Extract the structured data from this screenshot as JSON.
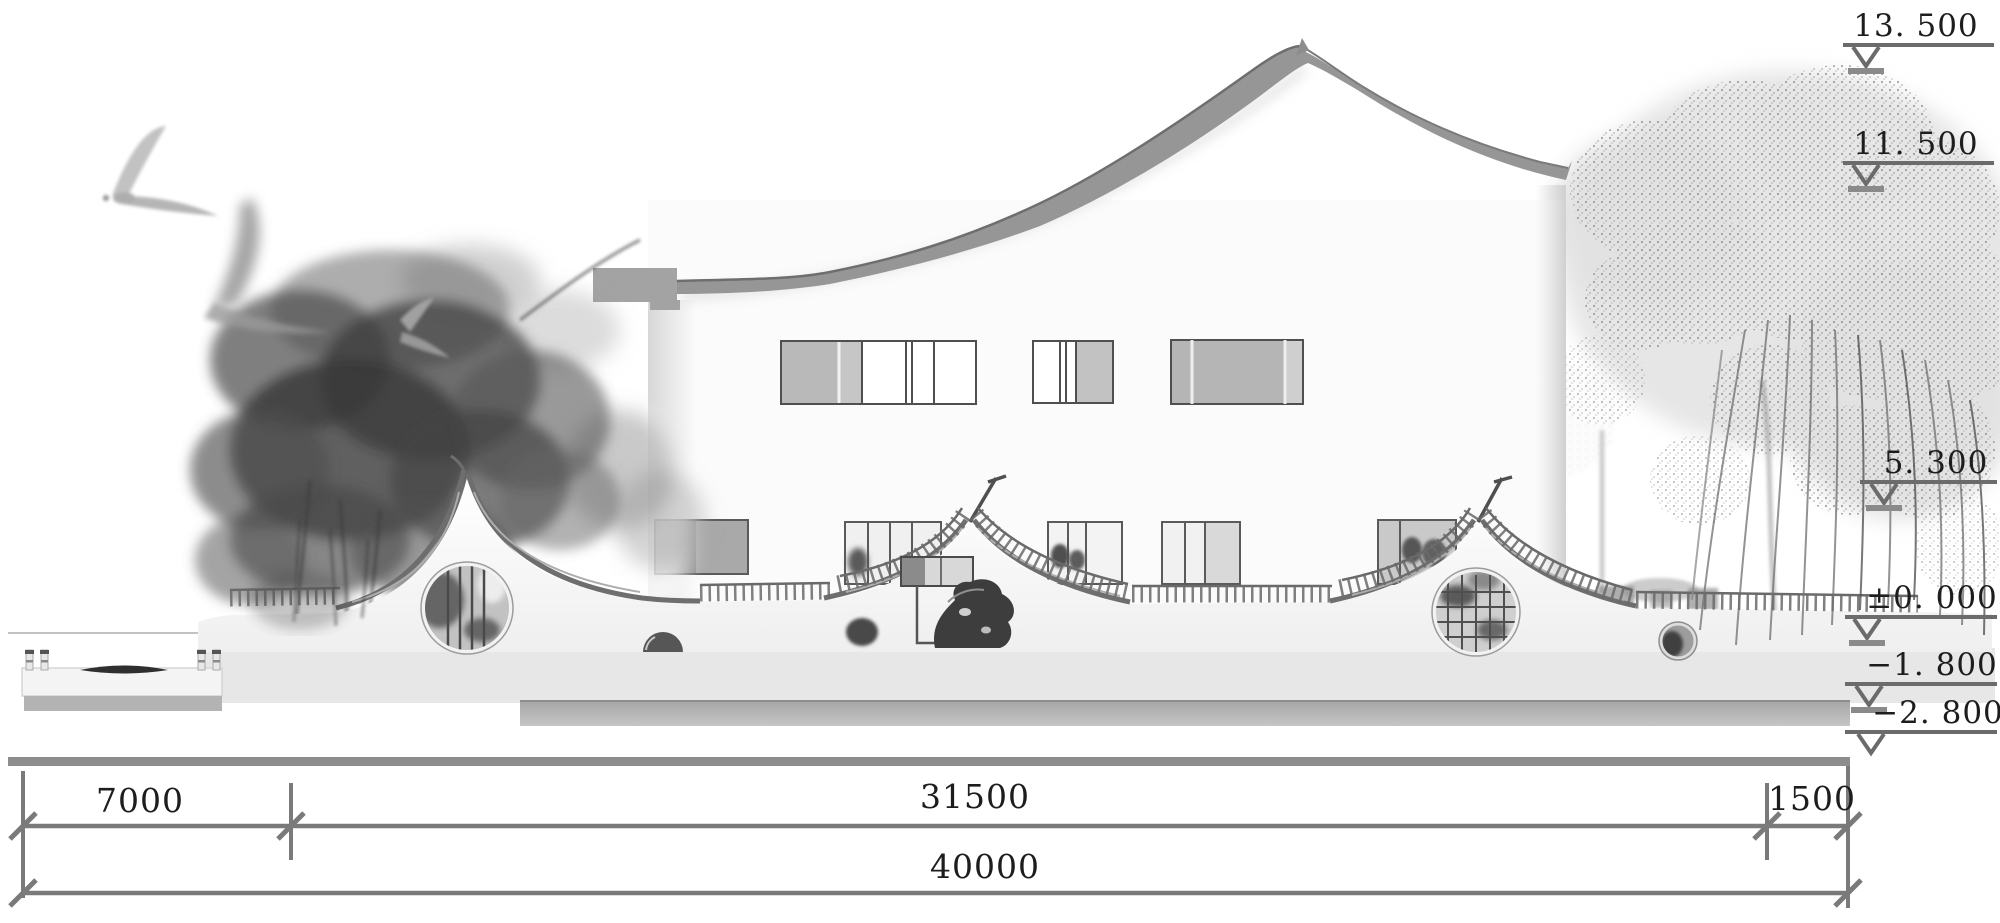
{
  "drawing": {
    "type": "architectural-elevation",
    "elevation_markers": [
      {
        "label": "13. 500"
      },
      {
        "label": "11. 500"
      },
      {
        "label": "5. 300"
      },
      {
        "label": "±0. 000"
      },
      {
        "label": "−1. 800"
      },
      {
        "label": "−2. 800"
      }
    ],
    "dimensions": {
      "row1": [
        "7000",
        "31500",
        "1500"
      ],
      "total": "40000"
    },
    "palette": {
      "line_gray": "#7a7a7a",
      "roof_gray": "#969696",
      "coping_gray": "#6e6e6e",
      "text_black": "#1d1d1d",
      "wall_white": "#f8f8f8",
      "ink_dark": "#3c3c3c",
      "stipple_gray": "#a8a8a8"
    }
  }
}
